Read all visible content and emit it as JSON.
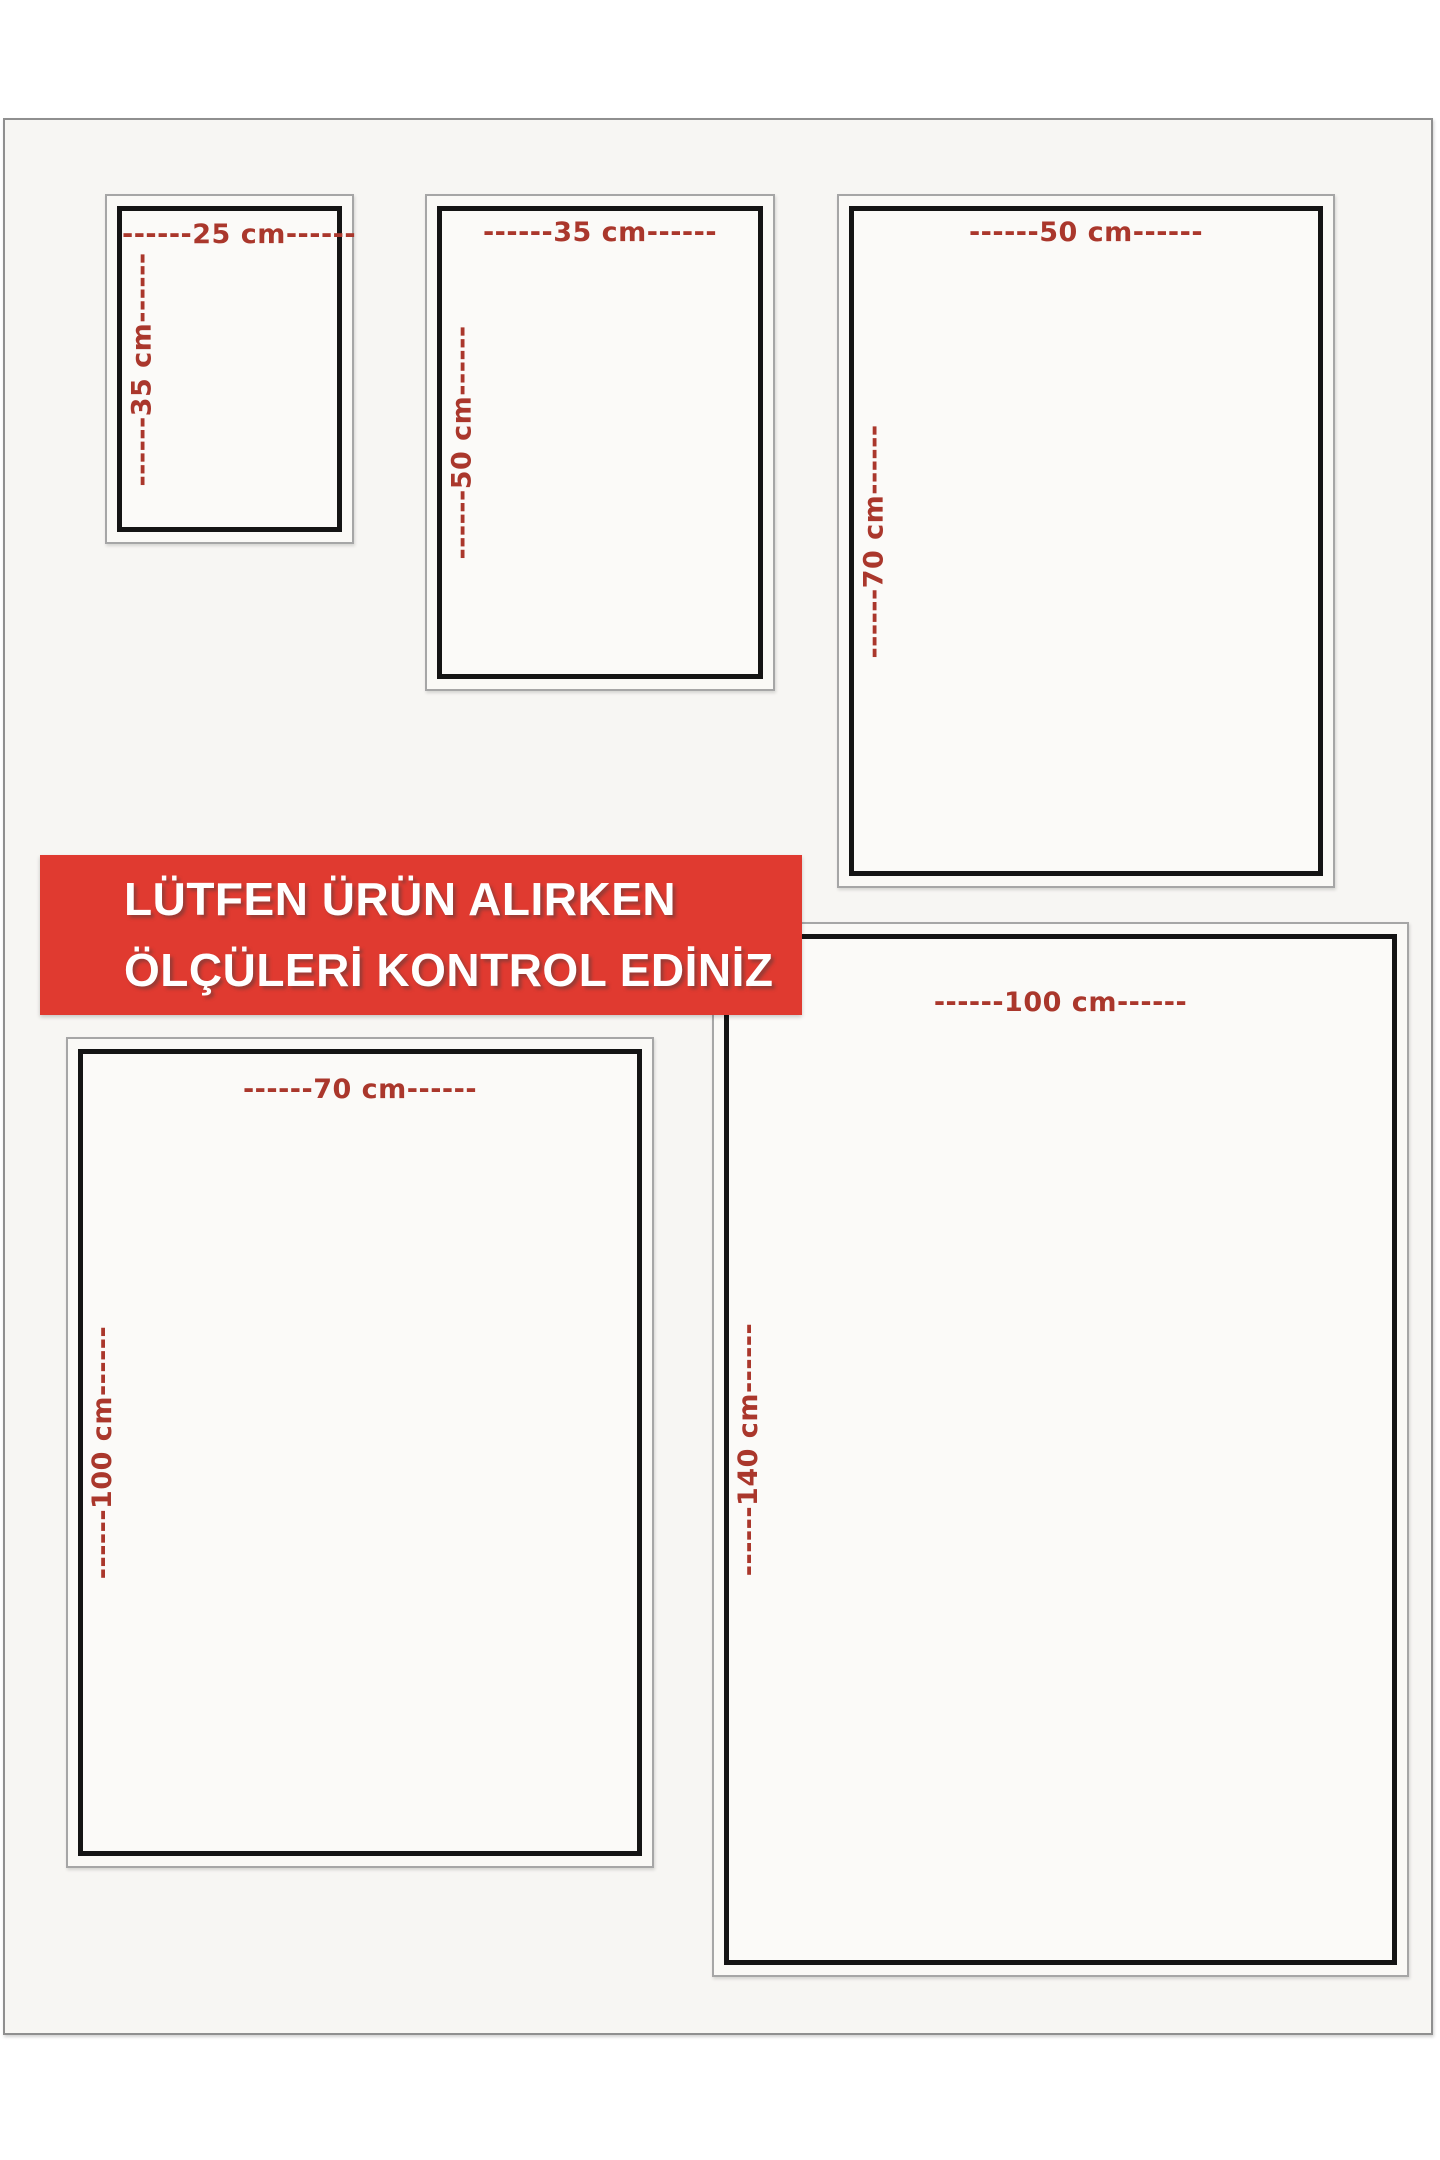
{
  "notice": {
    "line1": "LÜTFEN ÜRÜN ALIRKEN",
    "line2": "ÖLÇÜLERİ KONTROL EDİNİZ"
  },
  "colors": {
    "banner_bg": "#e03a30",
    "banner_text": "#ffffff",
    "dimension_label_red": "#aa372c",
    "inner_frame_black": "#141414",
    "outer_outline_gray": "#a6a6a6",
    "canvas_bg": "#f7f6f3",
    "page_bg": "#ffffff"
  },
  "sizes": [
    {
      "name": "25x35 cm",
      "width_cm": "25 cm",
      "height_cm": "35 cm",
      "width_label": "------25 cm------",
      "height_label": "------35 cm------"
    },
    {
      "name": "35x50 cm",
      "width_cm": "35 cm",
      "height_cm": "50 cm",
      "width_label": "------35 cm------",
      "height_label": "------50 cm------"
    },
    {
      "name": "50x70 cm",
      "width_cm": "50 cm",
      "height_cm": "70 cm",
      "width_label": "------50 cm------",
      "height_label": "------70 cm------"
    },
    {
      "name": "70x100 cm",
      "width_cm": "70 cm",
      "height_cm": "100 cm",
      "width_label": "------70 cm------",
      "height_label": "------100 cm------"
    },
    {
      "name": "100x140 cm",
      "width_cm": "100 cm",
      "height_cm": "140 cm",
      "width_label": "------100 cm------",
      "height_label": "------140 cm------"
    }
  ]
}
